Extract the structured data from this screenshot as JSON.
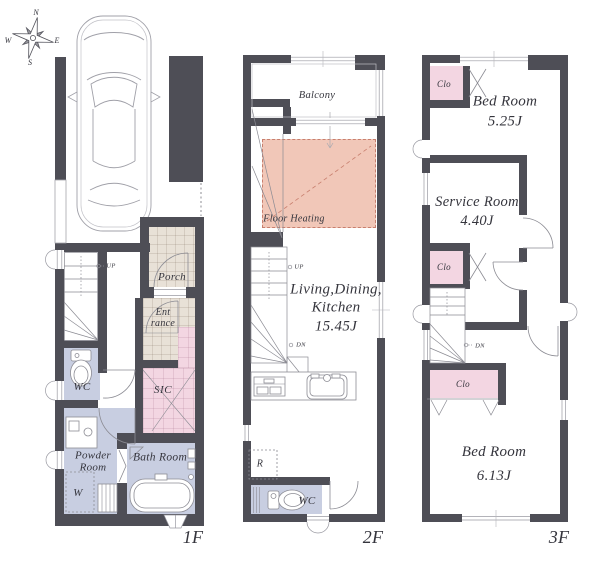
{
  "colors": {
    "wall": "#4e4e56",
    "lavender": "#c8cee1",
    "pink": "#f3d6e2",
    "beige": "#e8e1d7",
    "heating": "#f1c7b8",
    "heating_line": "#c87f6e",
    "line": "#8b8b93",
    "ink": "#35353d"
  },
  "compass": {
    "n": "N",
    "e": "E",
    "s": "S",
    "w": "W"
  },
  "f1": {
    "floor_label": "1F",
    "porch": "Porch",
    "entrance_line1": "Ent",
    "entrance_line2": "rance",
    "sic": "SIC",
    "wc": "WC",
    "powder_line1": "Powder",
    "powder_line2": "Room",
    "washer": "W",
    "bath": "Bath Room",
    "up": "UP"
  },
  "f2": {
    "floor_label": "2F",
    "balcony": "Balcony",
    "floor_heating": "Floor Heating",
    "ldk_line1": "Living,Dining,",
    "ldk_line2": "Kitchen",
    "ldk_line3": "15.45J",
    "up": "UP",
    "dn": "DN",
    "fridge": "R",
    "wc": "WC"
  },
  "f3": {
    "floor_label": "3F",
    "closet1": "Clo",
    "closet2": "Clo",
    "closet3": "Clo",
    "bed1": "Bed Room",
    "bed1_size": "5.25J",
    "service": "Service Room",
    "service_size": "4.40J",
    "bed2": "Bed Room",
    "bed2_size": "6.13J",
    "dn": "DN"
  }
}
